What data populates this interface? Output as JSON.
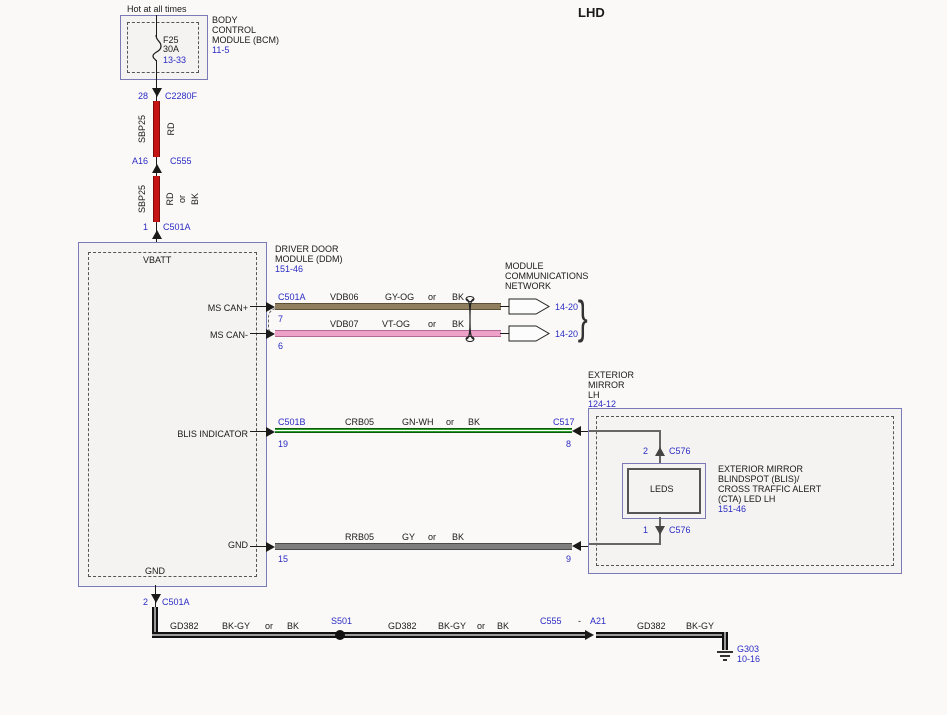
{
  "title": "LHD",
  "power": {
    "hot": "Hot at all times",
    "fuse_name": "F25",
    "fuse_rating": "30A",
    "fuse_ref": "13-33",
    "bcm_line1": "BODY",
    "bcm_line2": "CONTROL",
    "bcm_line3": "MODULE (BCM)",
    "bcm_ref": "11-5"
  },
  "feed": {
    "pin_28": "28",
    "conn_c2280f": "C2280F",
    "seg1_circuit": "SBP25",
    "seg1_color": "RD",
    "pin_a16": "A16",
    "conn_c555": "C555",
    "seg2_circuit": "SBP25",
    "seg2_color": "RD",
    "seg2_or": "or",
    "seg2_alt": "BK",
    "pin_1": "1",
    "conn_c501a": "C501A"
  },
  "ddm": {
    "title1": "DRIVER DOOR",
    "title2": "MODULE (DDM)",
    "ref": "151-46",
    "vbatt": "VBATT",
    "ms_can_p": "MS CAN+",
    "ms_can_n": "MS CAN-",
    "blis": "BLIS INDICATOR",
    "gnd": "GND",
    "gnd_bottom": "GND"
  },
  "mcn": {
    "line1": "MODULE",
    "line2": "COMMUNICATIONS",
    "line3": "NETWORK",
    "ref1": "14-20",
    "ref2": "14-20",
    "brace": "}"
  },
  "wire_can_p": {
    "conn": "C501A",
    "pin": "7",
    "circuit": "VDB06",
    "color": "GY-OG",
    "or": "or",
    "alt": "BK"
  },
  "wire_can_n": {
    "pin": "6",
    "circuit": "VDB07",
    "color": "VT-OG",
    "or": "or",
    "alt": "BK"
  },
  "wire_blis": {
    "conn_l": "C501B",
    "pin_l": "19",
    "circuit": "CRB05",
    "color": "GN-WH",
    "or": "or",
    "alt": "BK",
    "conn_r": "C517",
    "pin_r": "8"
  },
  "wire_gnd": {
    "pin_l": "15",
    "circuit": "RRB05",
    "color": "GY",
    "or": "or",
    "alt": "BK",
    "pin_r": "9"
  },
  "mirror": {
    "title1": "EXTERIOR",
    "title2": "MIRROR",
    "title3": "LH",
    "ref": "124-12",
    "leds": "LEDS",
    "pin_top": "2",
    "conn_top": "C576",
    "pin_bot": "1",
    "conn_bot": "C576",
    "desc1": "EXTERIOR MIRROR",
    "desc2": "BLINDSPOT (BLIS)/",
    "desc3": "CROSS TRAFFIC ALERT",
    "desc4": "(CTA) LED LH",
    "desc_ref": "151-46"
  },
  "ground_run": {
    "pin_2": "2",
    "conn": "C501A",
    "seg1_circuit": "GD382",
    "seg1_color": "BK-GY",
    "seg1_or": "or",
    "seg1_alt": "BK",
    "splice": "S501",
    "seg2_circuit": "GD382",
    "seg2_color": "BK-GY",
    "seg2_or": "or",
    "seg2_alt": "BK",
    "conn2_a": "C555",
    "conn2_dash": "-",
    "conn2_b": "A21",
    "seg3_circuit": "GD382",
    "seg3_color": "BK-GY",
    "ground": "G303",
    "ground_ref": "10-16"
  },
  "colors": {
    "ref_blue": "#2b2bc4",
    "red_wire": "#c61414",
    "gy_og_wire": "#8f7f5f",
    "vt_og_wire": "#eda0c8",
    "gn_wh_wire": "#2f9e2f",
    "gy_wire": "#7d7d7d",
    "bk_gy_wire": "#111111",
    "box_border": "#7a7ab8"
  }
}
